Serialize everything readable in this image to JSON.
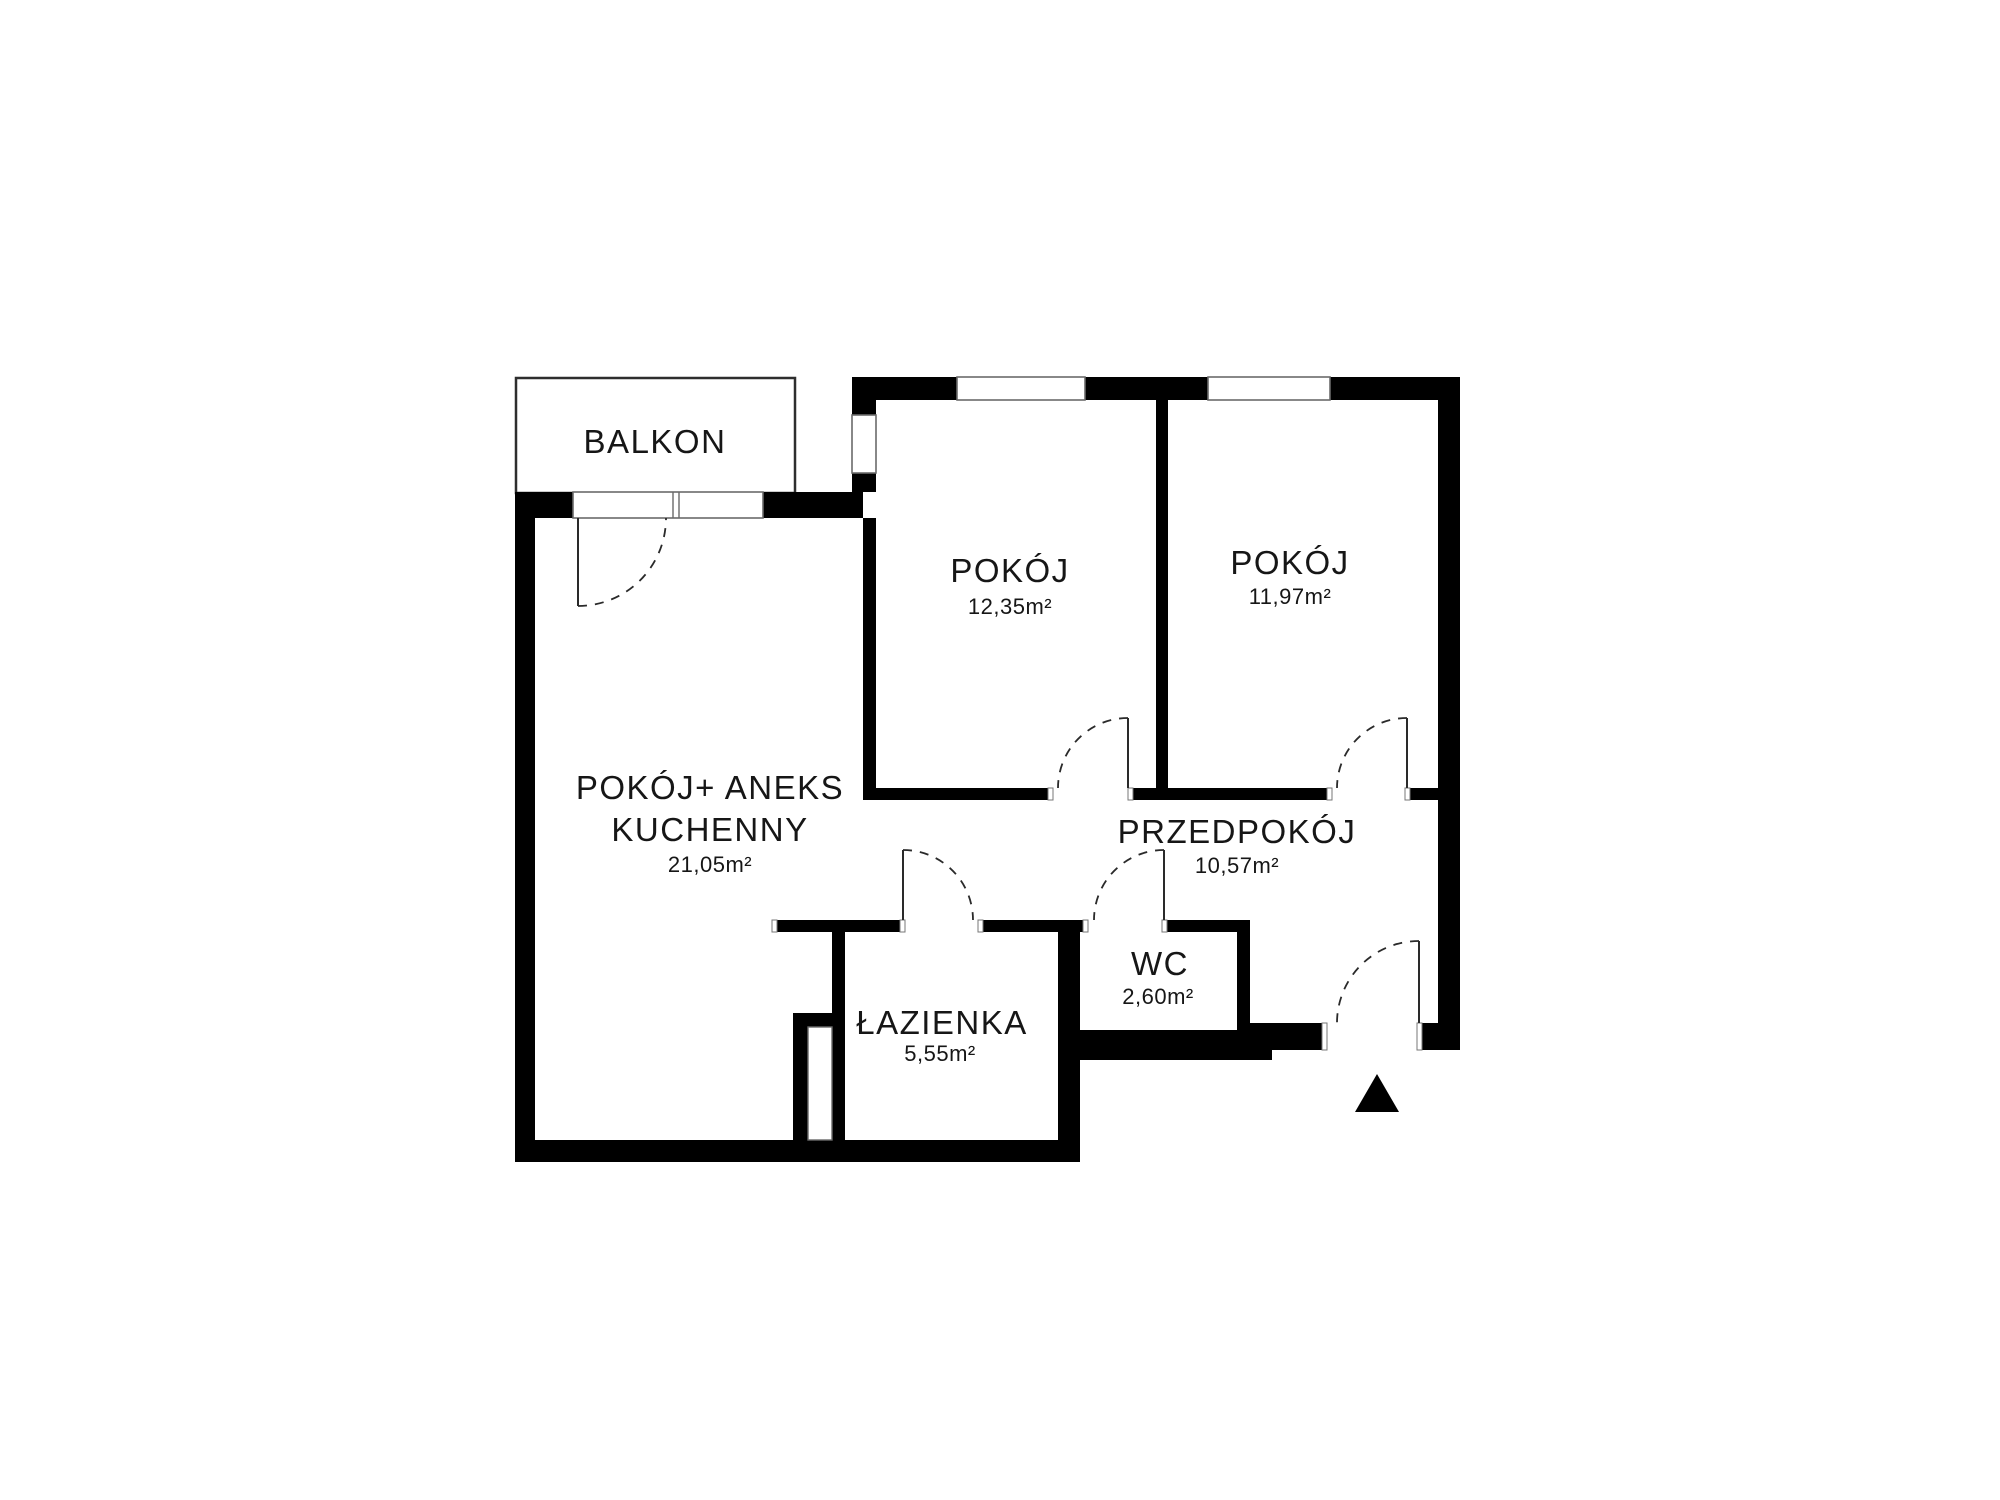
{
  "floorplan": {
    "balcony": {
      "label": "BALKON"
    },
    "rooms": [
      {
        "id": "room-1",
        "label": "POKÓJ",
        "area": "12,35m²"
      },
      {
        "id": "room-2",
        "label": "POKÓJ",
        "area": "11,97m²"
      },
      {
        "id": "living",
        "label_line1": "POKÓJ+ ANEKS",
        "label_line2": "KUCHENNY",
        "area": "21,05m²"
      },
      {
        "id": "hallway",
        "label": "PRZEDPOKÓJ",
        "area": "10,57m²"
      },
      {
        "id": "wc",
        "label": "WC",
        "area": "2,60m²"
      },
      {
        "id": "bathroom",
        "label": "ŁAZIENKA",
        "area": "5,55m²"
      }
    ],
    "entrance_marker": "triangle-up",
    "colors": {
      "wall": "#000000",
      "background": "#ffffff",
      "text": "#161616"
    }
  }
}
